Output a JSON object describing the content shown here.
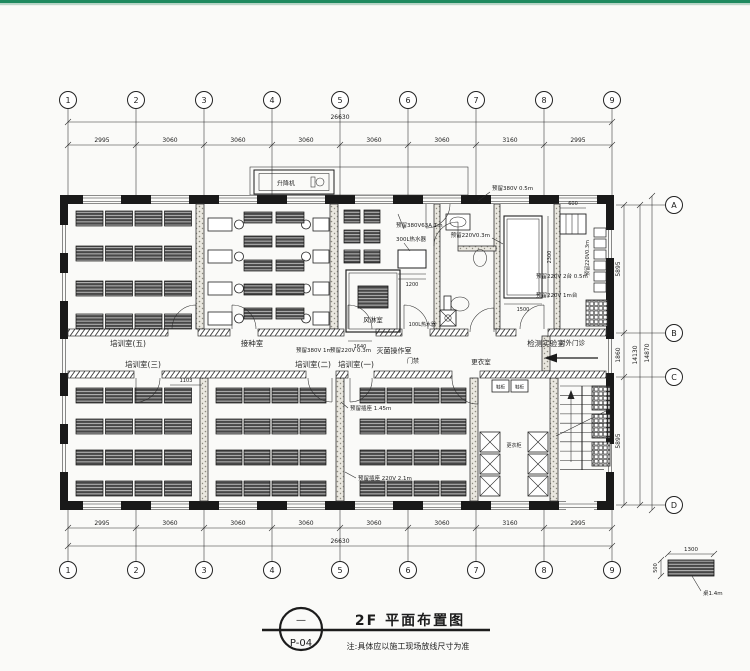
{
  "colors": {
    "ink": "#1c1c1c",
    "paper": "#fafaf8",
    "strip": "#1f8a5f"
  },
  "grid": {
    "cols": [
      "1",
      "2",
      "3",
      "4",
      "5",
      "6",
      "7",
      "8",
      "9"
    ],
    "top_dims": [
      "2995",
      "3060",
      "3060",
      "3060",
      "3060",
      "3060",
      "3160",
      "2995"
    ],
    "top_total": "26630",
    "bot_dims": [
      "2995",
      "3060",
      "3060",
      "3060",
      "3060",
      "3060",
      "3160",
      "2995"
    ],
    "bot_total": "26630",
    "rows": [
      "A",
      "B",
      "C",
      "D"
    ],
    "row_dims": [
      "5895",
      "1860",
      "5895"
    ],
    "row_total_1": "14130",
    "row_total_2": "14870"
  },
  "rooms": {
    "r5": "培训室(五)",
    "inoc": "接种室",
    "steril": "灭菌操作室",
    "lab": "检测实验室",
    "clinic": "对外门诊",
    "r3": "培训室(三)",
    "r2": "培训室(二)",
    "r1": "培训室(一)",
    "locker": "更衣室",
    "shower": "风淋室",
    "lift": "升降机",
    "access": "门禁",
    "wardrobe": "更衣柜",
    "shoe1": "鞋柜",
    "shoe2": "鞋柜"
  },
  "annotations": {
    "a380_05": "预留380V 0.5m",
    "a380_63": "预留380V63A 1m",
    "heater300": "300L热水器",
    "a220_03a": "预留220V0.3m",
    "a220_03b": "预留220V0.3m",
    "a220_03c": "预留220V 0.3m",
    "a220_2t": "预留220V 2台 0.5m",
    "a220_1m": "预留220V 1m台",
    "a380_1m": "预留380V 1m",
    "heater100": "100L热水器",
    "socket145": "预留插座 1.45m",
    "socket21": "预留插座 220V 2.1m"
  },
  "dims": {
    "d1103": "1103",
    "d1640": "1640",
    "d1200": "1200",
    "d1500": "1500",
    "d2300": "2300",
    "d600": "600"
  },
  "legend": {
    "w": "1300",
    "h": "500",
    "label": "桌1.4m"
  },
  "title_block": {
    "rev": "—",
    "sheet": "P-04",
    "title": "2F 平面布置图",
    "note": "注:具体应以施工现场放线尺寸为准"
  }
}
